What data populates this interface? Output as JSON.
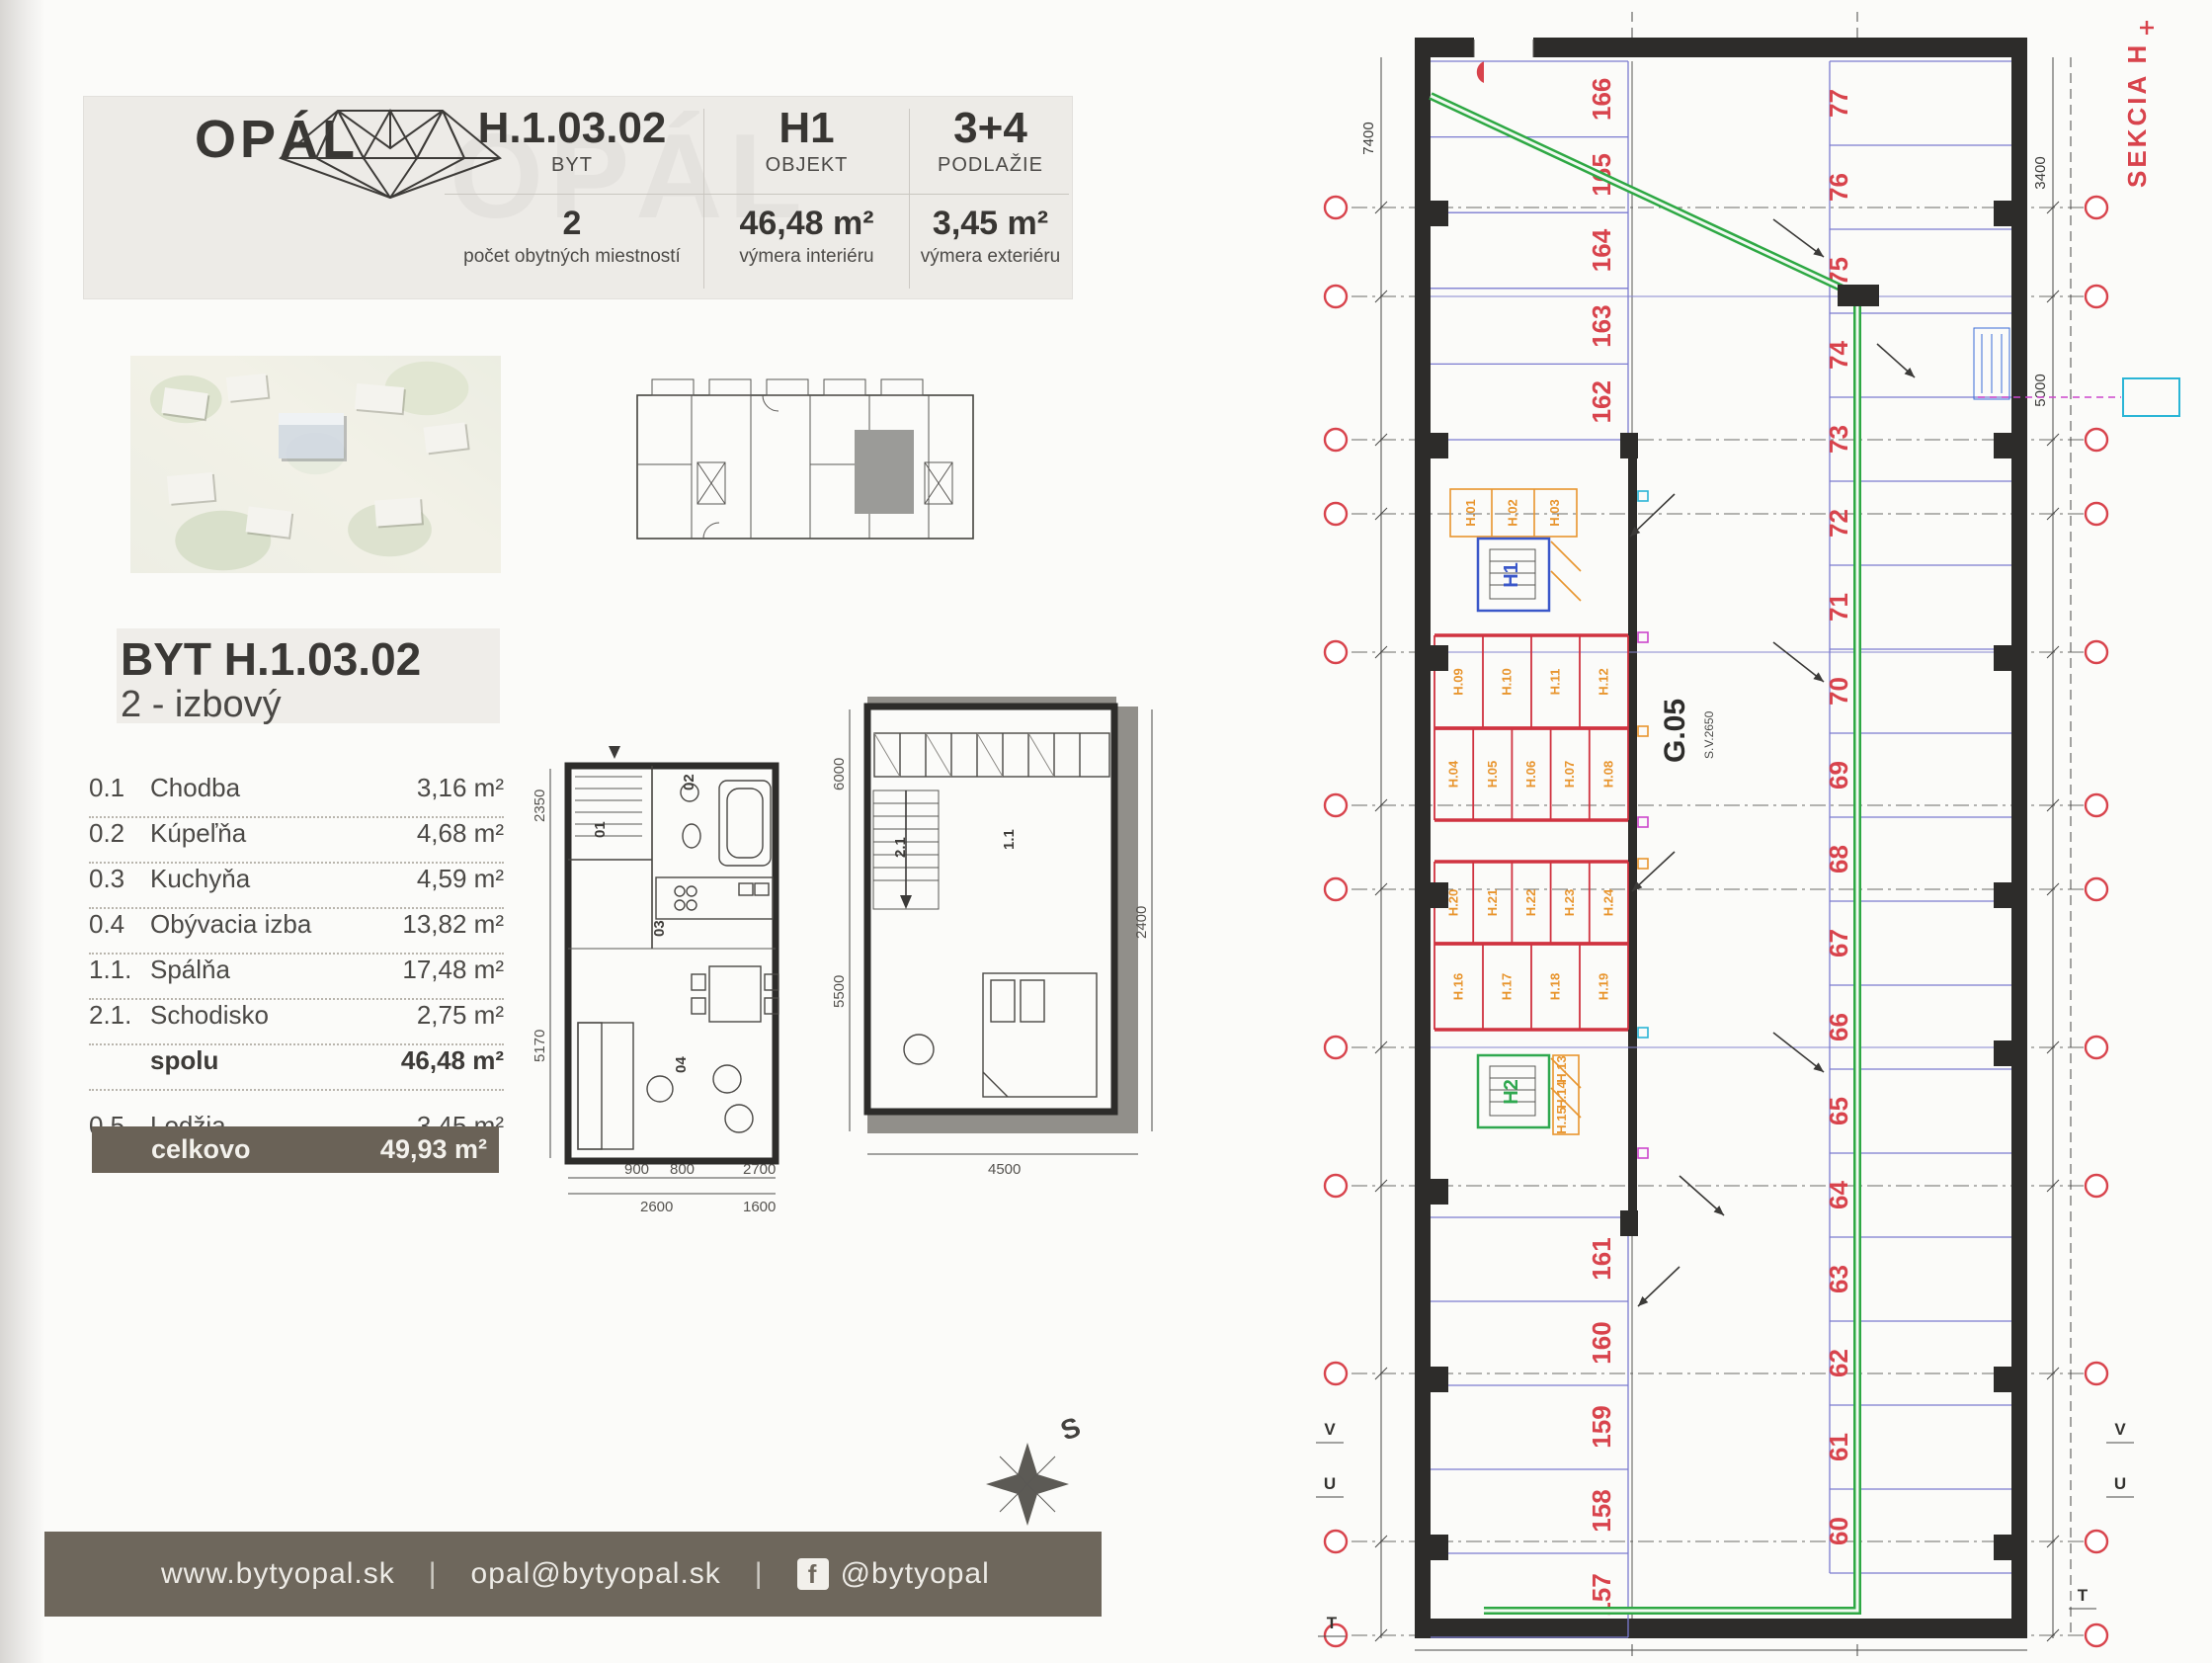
{
  "document": {
    "brand": "OPÁL",
    "header": {
      "columns": [
        {
          "value": "H.1.03.02",
          "label": "BYT",
          "value2": "2",
          "label2": "počet obytných miestností"
        },
        {
          "value": "H1",
          "label": "OBJEKT",
          "value2": "46,48 m²",
          "label2": "výmera interiéru"
        },
        {
          "value": "3+4",
          "label": "PODLAŽIE",
          "value2": "3,45 m²",
          "label2": "výmera exteriéru"
        }
      ]
    },
    "title": {
      "line1": "BYT H.1.03.02",
      "line2": "2 - izbový"
    },
    "room_table": {
      "rows": [
        {
          "num": "0.1",
          "name": "Chodba",
          "area": "3,16 m²",
          "bold": false
        },
        {
          "num": "0.2",
          "name": "Kúpeľňa",
          "area": "4,68 m²",
          "bold": false
        },
        {
          "num": "0.3",
          "name": "Kuchyňa",
          "area": "4,59 m²",
          "bold": false
        },
        {
          "num": "0.4",
          "name": "Obývacia izba",
          "area": "13,82 m²",
          "bold": false
        },
        {
          "num": "1.1.",
          "name": "Spálňa",
          "area": "17,48 m²",
          "bold": false
        },
        {
          "num": "2.1.",
          "name": "Schodisko",
          "area": "2,75 m²",
          "bold": false
        },
        {
          "num": "",
          "name": "spolu",
          "area": "46,48 m²",
          "bold": true
        }
      ],
      "loggia_row": {
        "num": "0.5",
        "name": "Lodžia",
        "area": "3,45 m²"
      },
      "total_row": {
        "name": "celkovo",
        "area": "49,93 m²"
      }
    },
    "compass_label": "S",
    "footer": {
      "website": "www.bytyopal.sk",
      "email": "opal@bytyopal.sk",
      "facebook": "@bytyopal",
      "fb_icon": "f",
      "separator": "|"
    }
  },
  "floorplans": {
    "lower": {
      "room_labels": [
        "01",
        "02",
        "03",
        "04"
      ],
      "dims_left": [
        "2350",
        "5170"
      ],
      "dims_bottom": [
        "2600",
        "1600"
      ],
      "dims_inner": [
        "900",
        "800",
        "2700"
      ]
    },
    "upper": {
      "room_labels": [
        "1.1",
        "2.1"
      ],
      "dims_left": [
        "6000",
        "5500"
      ],
      "dim_right": "2400",
      "dim_bottom": "4500"
    }
  },
  "drawing": {
    "section_label": "SEKCIA H",
    "area_label": "G.05",
    "area_sublabel": "S.V.2650",
    "unit_upper": "H1",
    "unit_lower": "H2",
    "parking_left_upper": [
      "166",
      "165",
      "164",
      "163",
      "162"
    ],
    "parking_left_lower": [
      "161",
      "160",
      "159",
      "158",
      "157"
    ],
    "parking_right": [
      "77",
      "76",
      "75",
      "74",
      "73",
      "72",
      "71",
      "70",
      "69",
      "68",
      "67",
      "66",
      "65",
      "64",
      "63",
      "62",
      "61",
      "60"
    ],
    "storage_bands": [
      {
        "labels": [
          "H.09",
          "H.10",
          "H.11",
          "H.12"
        ]
      },
      {
        "labels": [
          "H.04",
          "H.05",
          "H.06",
          "H.07",
          "H.08"
        ]
      },
      {
        "labels": [
          "H.20",
          "H.21",
          "H.22",
          "H.23",
          "H.24"
        ]
      },
      {
        "labels": [
          "H.16",
          "H.17",
          "H.18",
          "H.19"
        ]
      }
    ],
    "core_cluster_upper": [
      "H.01",
      "H.02",
      "H.03"
    ],
    "core_cluster_lower": [
      "H.13",
      "H.14",
      "H.15"
    ],
    "dims": {
      "left": "7400",
      "right_upper": "3400",
      "right_lower": "5000"
    },
    "section_marks": {
      "left": [
        "V",
        "U"
      ],
      "right": [
        "V",
        "U"
      ],
      "bottom_left": "T",
      "bottom_right": "T"
    },
    "colors": {
      "stall_line": "#7b7bd0",
      "number_red": "#d8434c",
      "storage_orange": "#e8952e",
      "ramp_green": "#2ea844",
      "wall": "#2d2c2a",
      "accent_bar": "#6e675c"
    }
  }
}
